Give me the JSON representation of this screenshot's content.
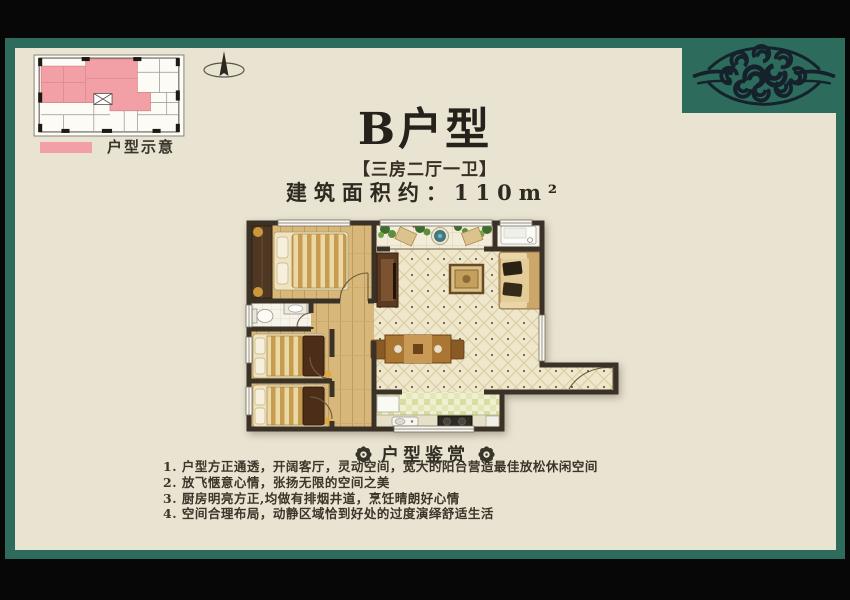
{
  "header": {
    "title": "B户型",
    "subtitle": "【三房二厅一卫】",
    "area_label": "建筑面积约：110m²"
  },
  "key_plan": {
    "legend_label": "户型示意",
    "highlight_color": "#f2a0a6"
  },
  "appreciation": {
    "title": "户型鉴赏",
    "items": [
      "1. 户型方正通透，开阔客厅，灵动空间，宽大的阳台营造最佳放松休闲空间",
      "2. 放飞惬意心情，张扬无限的空间之美",
      "3. 厨房明亮方正,均做有排烟井道，烹饪晴朗好心情",
      "4. 空间合理布局，动静区域恰到好处的过度演绎舒适生活"
    ]
  },
  "colors": {
    "frame_teal": "#2d6b5c",
    "paper_cream": "#e9e3d1",
    "highlight_pink": "#f2a0a6",
    "ornament_ink": "#15212b",
    "wall_brown": "#3a3127",
    "wood_floor": "#d8b77b"
  }
}
